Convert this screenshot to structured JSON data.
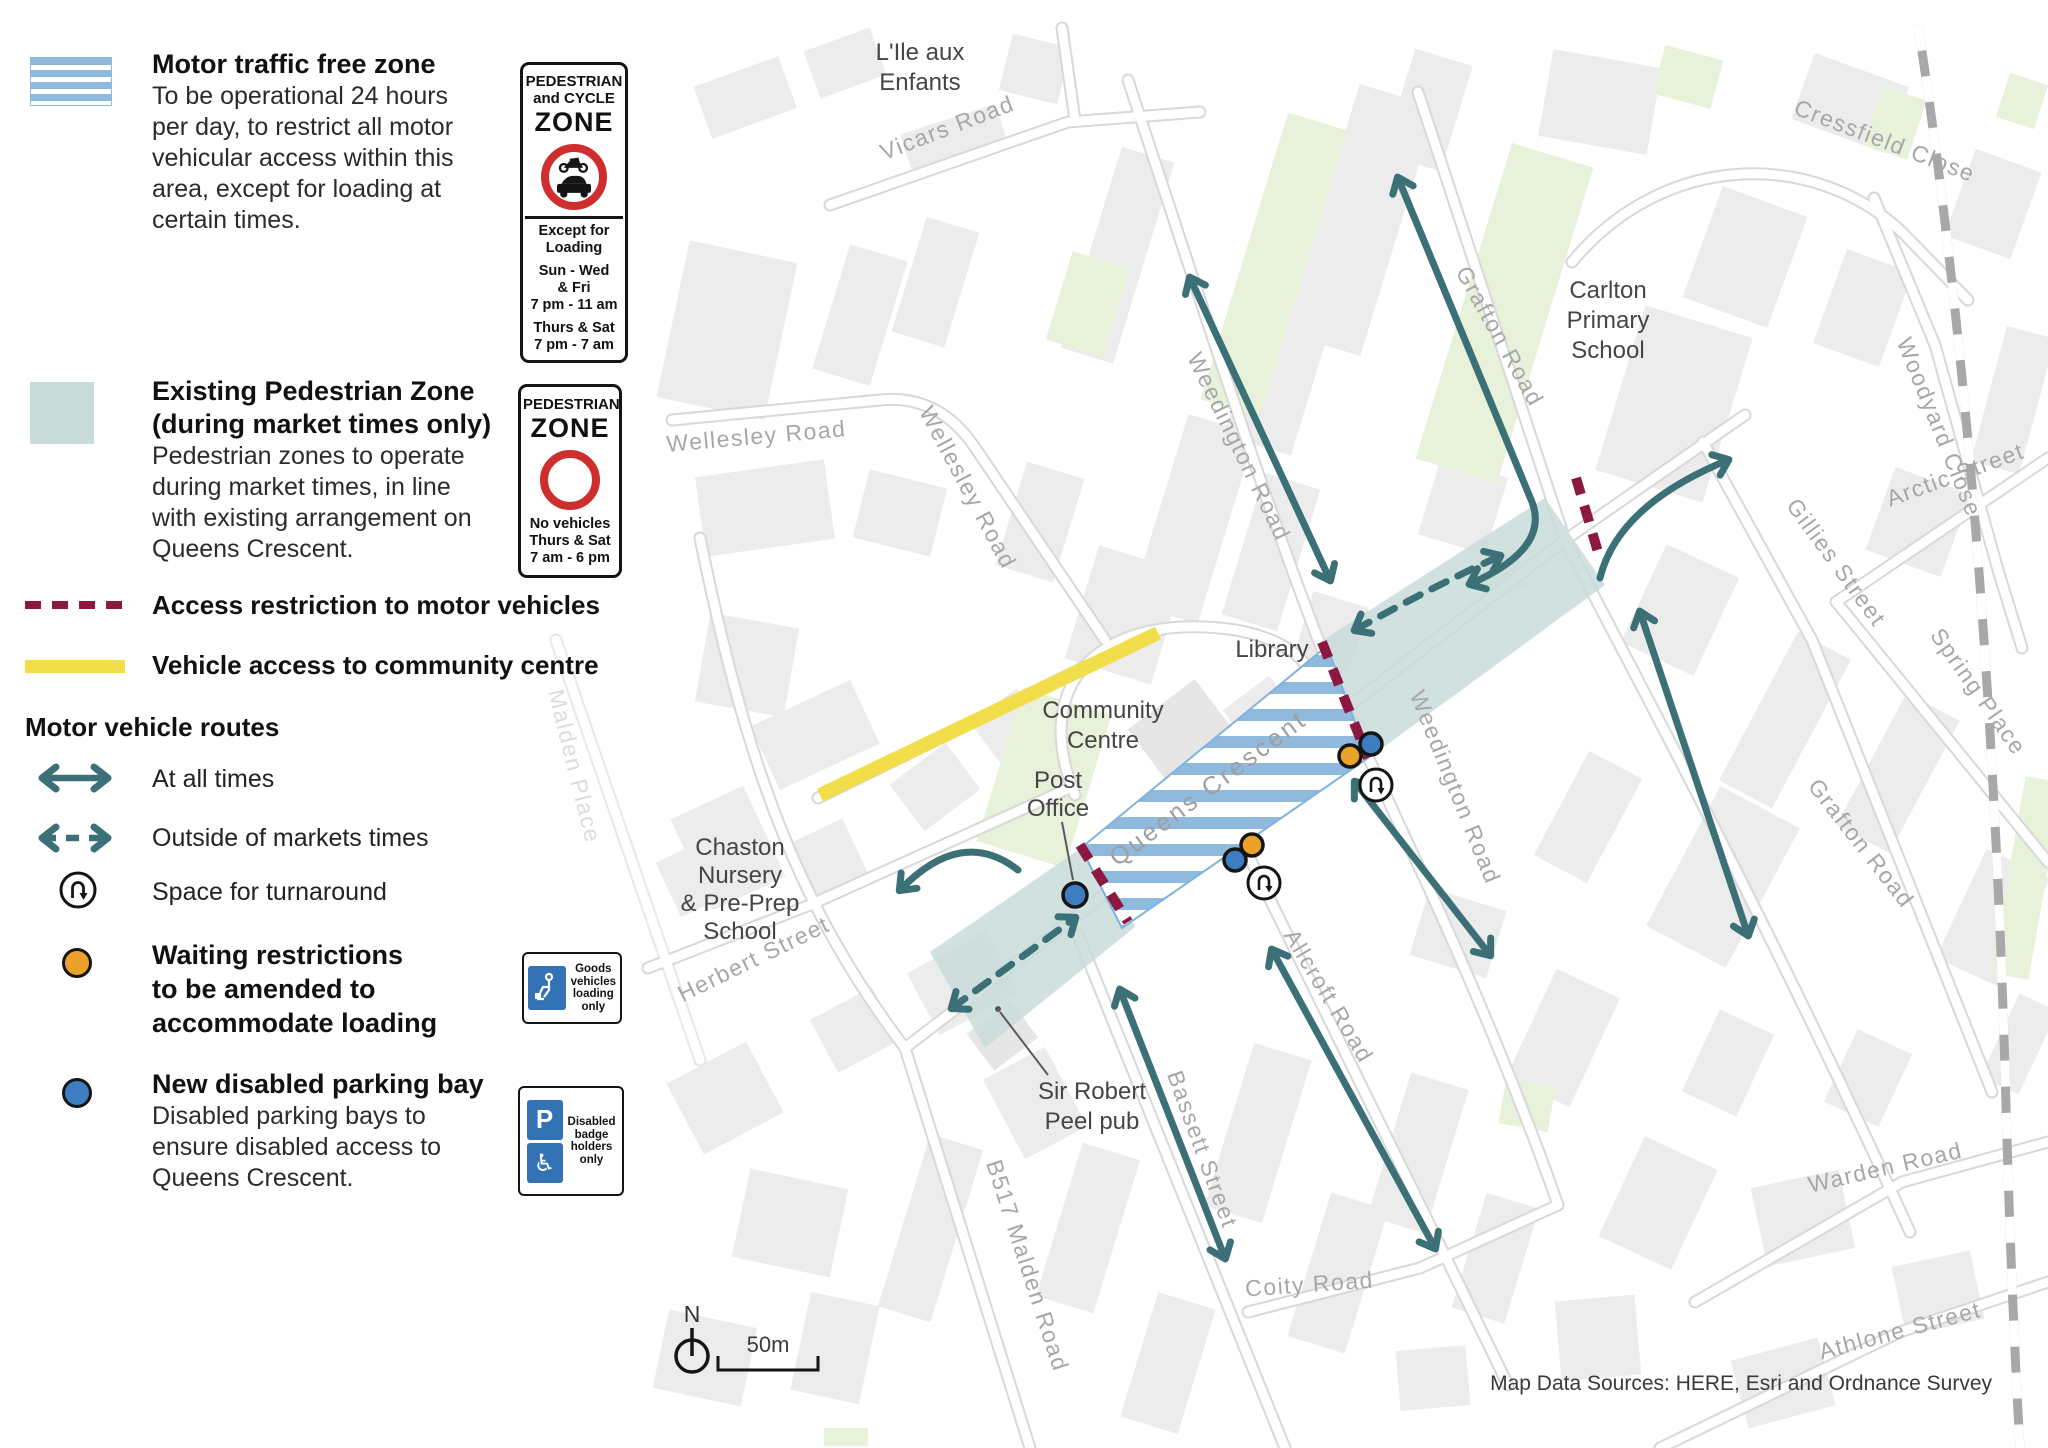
{
  "legend": {
    "motor_zone": {
      "title": "Motor traffic free zone",
      "lines": [
        "To be operational 24 hours",
        "per day, to restrict all motor",
        "vehicular access within this",
        "area, except for loading at",
        "certain times."
      ]
    },
    "ped_cycle_sign": {
      "line1": "PEDESTRIAN",
      "line2": "and CYCLE",
      "zone": "ZONE",
      "except1": "Except for",
      "except2": "Loading",
      "days1": "Sun - Wed",
      "days2": "& Fri",
      "time1": "7 pm - 11 am",
      "days3": "Thurs & Sat",
      "time2": "7 pm - 7 am"
    },
    "ped_zone": {
      "title1": "Existing Pedestrian Zone",
      "title2": "(during market times only)",
      "lines": [
        "Pedestrian zones to operate",
        "during market times, in line",
        "with existing arrangement on",
        "Queens Crescent."
      ]
    },
    "ped_sign": {
      "line1": "PEDESTRIAN",
      "zone": "ZONE",
      "no1": "No vehicles",
      "no2": "Thurs & Sat",
      "no3": "7 am - 6 pm"
    },
    "access_restriction": "Access restriction to motor vehicles",
    "vehicle_access": "Vehicle access to community centre",
    "routes_heading": "Motor vehicle routes",
    "at_all_times": "At all times",
    "outside_markets": "Outside of markets times",
    "turnaround": "Space for turnaround",
    "waiting": {
      "lines": [
        "Waiting restrictions",
        "to be amended to",
        "accommodate loading"
      ]
    },
    "goods_sign": {
      "lines": [
        "Goods",
        "vehicles",
        "loading",
        "only"
      ]
    },
    "disabled": {
      "title": "New disabled parking bay",
      "lines": [
        "Disabled parking bays to",
        "ensure disabled access to",
        "Queens Crescent."
      ],
      "sign": {
        "p": "P",
        "lines": [
          "Disabled",
          "badge",
          "holders",
          "only"
        ]
      }
    }
  },
  "map": {
    "labels": {
      "lile1": "L'Ile aux",
      "lile2": "Enfants",
      "vicars": "Vicars Road",
      "cressfield": "Cressfield Close",
      "grafton_n": "Grafton Road",
      "grafton_s": "Grafton Road",
      "woodyard": "Woodyard Close",
      "carlton1": "Carlton",
      "carlton2": "Primary",
      "carlton3": "School",
      "weedington_n": "Weedington Road",
      "weedington_s": "Weedington Road",
      "wellesley_h": "Wellesley Road",
      "wellesley_v": "Wellesley Road",
      "gillies": "Gillies Street",
      "arctic": "Arctic Street",
      "spring": "Spring Place",
      "library": "Library",
      "community1": "Community",
      "community2": "Centre",
      "post1": "Post",
      "post2": "Office",
      "queens": "Queens Crescent",
      "chaston1": "Chaston",
      "chaston2": "Nursery",
      "chaston3": "& Pre-Prep",
      "chaston4": "School",
      "herbert": "Herbert Street",
      "malden_place": "Malden Place",
      "sirrobert1": "Sir Robert",
      "sirrobert2": "Peel pub",
      "b517": "B517 Malden Road",
      "bassett": "Bassett Street",
      "allcroft": "Allcroft Road",
      "coity": "Coity Road",
      "warden": "Warden Road",
      "athlone": "Athlone Street",
      "north": "N",
      "scale": "50m",
      "attribution": "Map Data Sources: HERE, Esri and Ordnance Survey"
    }
  },
  "colors": {
    "route_teal": "#3b7076",
    "restriction_maroon": "#8c1842",
    "access_yellow": "#f2de4a",
    "hatch_blue": "#8fb9dd",
    "pedestrian_zone_teal": "#c9dcda",
    "waiting_orange": "#eaa22b",
    "parking_blue": "#3d7ec2",
    "sign_blue": "#3272b5",
    "sign_red": "#cf2e2e"
  }
}
